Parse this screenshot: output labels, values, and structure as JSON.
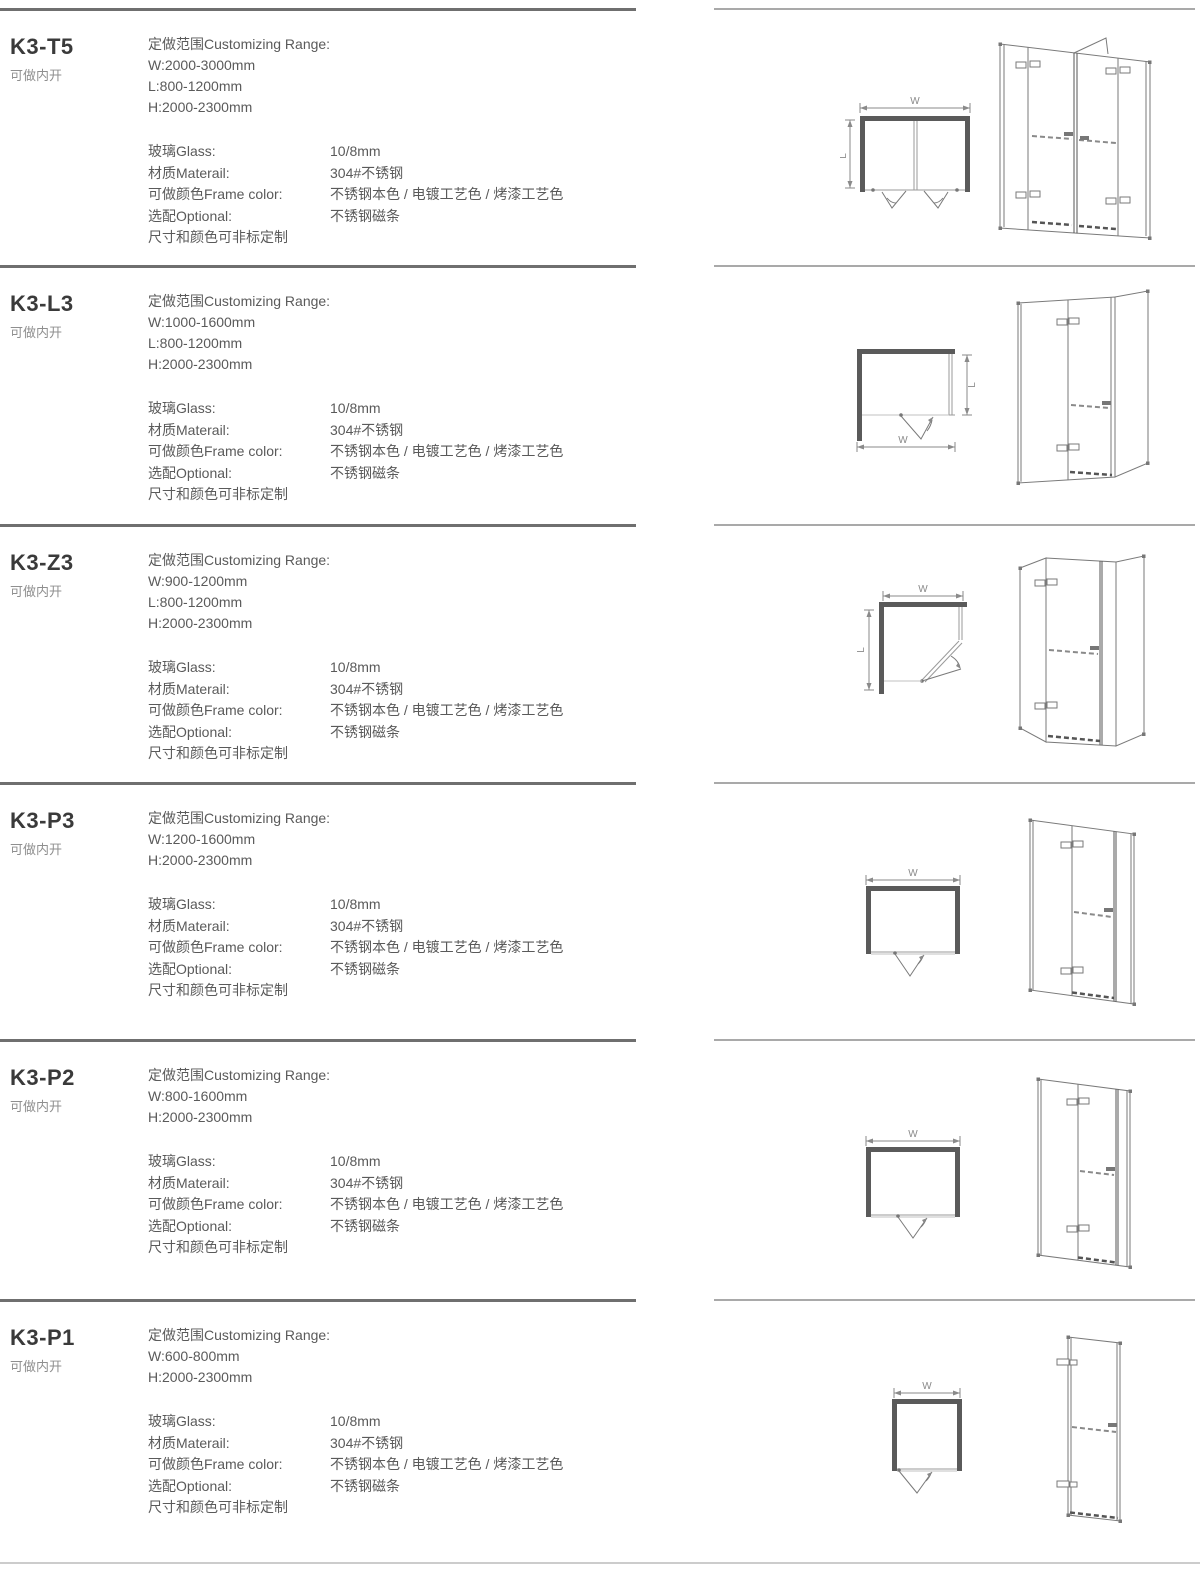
{
  "shared": {
    "range_label": "定做范围Customizing Range:",
    "spec_rows": [
      {
        "label": "玻璃Glass:",
        "value": "10/8mm"
      },
      {
        "label": "材质Materail:",
        "value": "304#不锈钢"
      },
      {
        "label": "可做颜色Frame color:",
        "value": "不锈钢本色 / 电镀工艺色 / 烤漆工艺色"
      },
      {
        "label": "选配Optional:",
        "value": "不锈钢磁条"
      }
    ],
    "footnote": "尺寸和颜色可非标定制",
    "colors": {
      "wall_fill": "#5a5a5a",
      "rule_left": "#6f6f6f",
      "rule_right": "#a9a9a9",
      "body_text": "#5a5a5a",
      "muted_text": "#8f8f8f"
    }
  },
  "sections": [
    {
      "model": "K3-T5",
      "subtitle": "可做内开",
      "range": [
        "W:2000-3000mm",
        "L:800-1200mm",
        "H:2000-2300mm"
      ],
      "dims": {
        "w": "W",
        "l": "L"
      }
    },
    {
      "model": "K3-L3",
      "subtitle": "可做内开",
      "range": [
        "W:1000-1600mm",
        "L:800-1200mm",
        "H:2000-2300mm"
      ],
      "dims": {
        "w": "W",
        "l": "L"
      }
    },
    {
      "model": "K3-Z3",
      "subtitle": "可做内开",
      "range": [
        "W:900-1200mm",
        "L:800-1200mm",
        "H:2000-2300mm"
      ],
      "dims": {
        "w": "W",
        "l": "L"
      }
    },
    {
      "model": "K3-P3",
      "subtitle": "可做内开",
      "range": [
        "W:1200-1600mm",
        "H:2000-2300mm"
      ],
      "dims": {
        "w": "W"
      }
    },
    {
      "model": "K3-P2",
      "subtitle": "可做内开",
      "range": [
        "W:800-1600mm",
        "H:2000-2300mm"
      ],
      "dims": {
        "w": "W"
      }
    },
    {
      "model": "K3-P1",
      "subtitle": "可做内开",
      "range": [
        "W:600-800mm",
        "H:2000-2300mm"
      ],
      "dims": {
        "w": "W"
      }
    }
  ]
}
